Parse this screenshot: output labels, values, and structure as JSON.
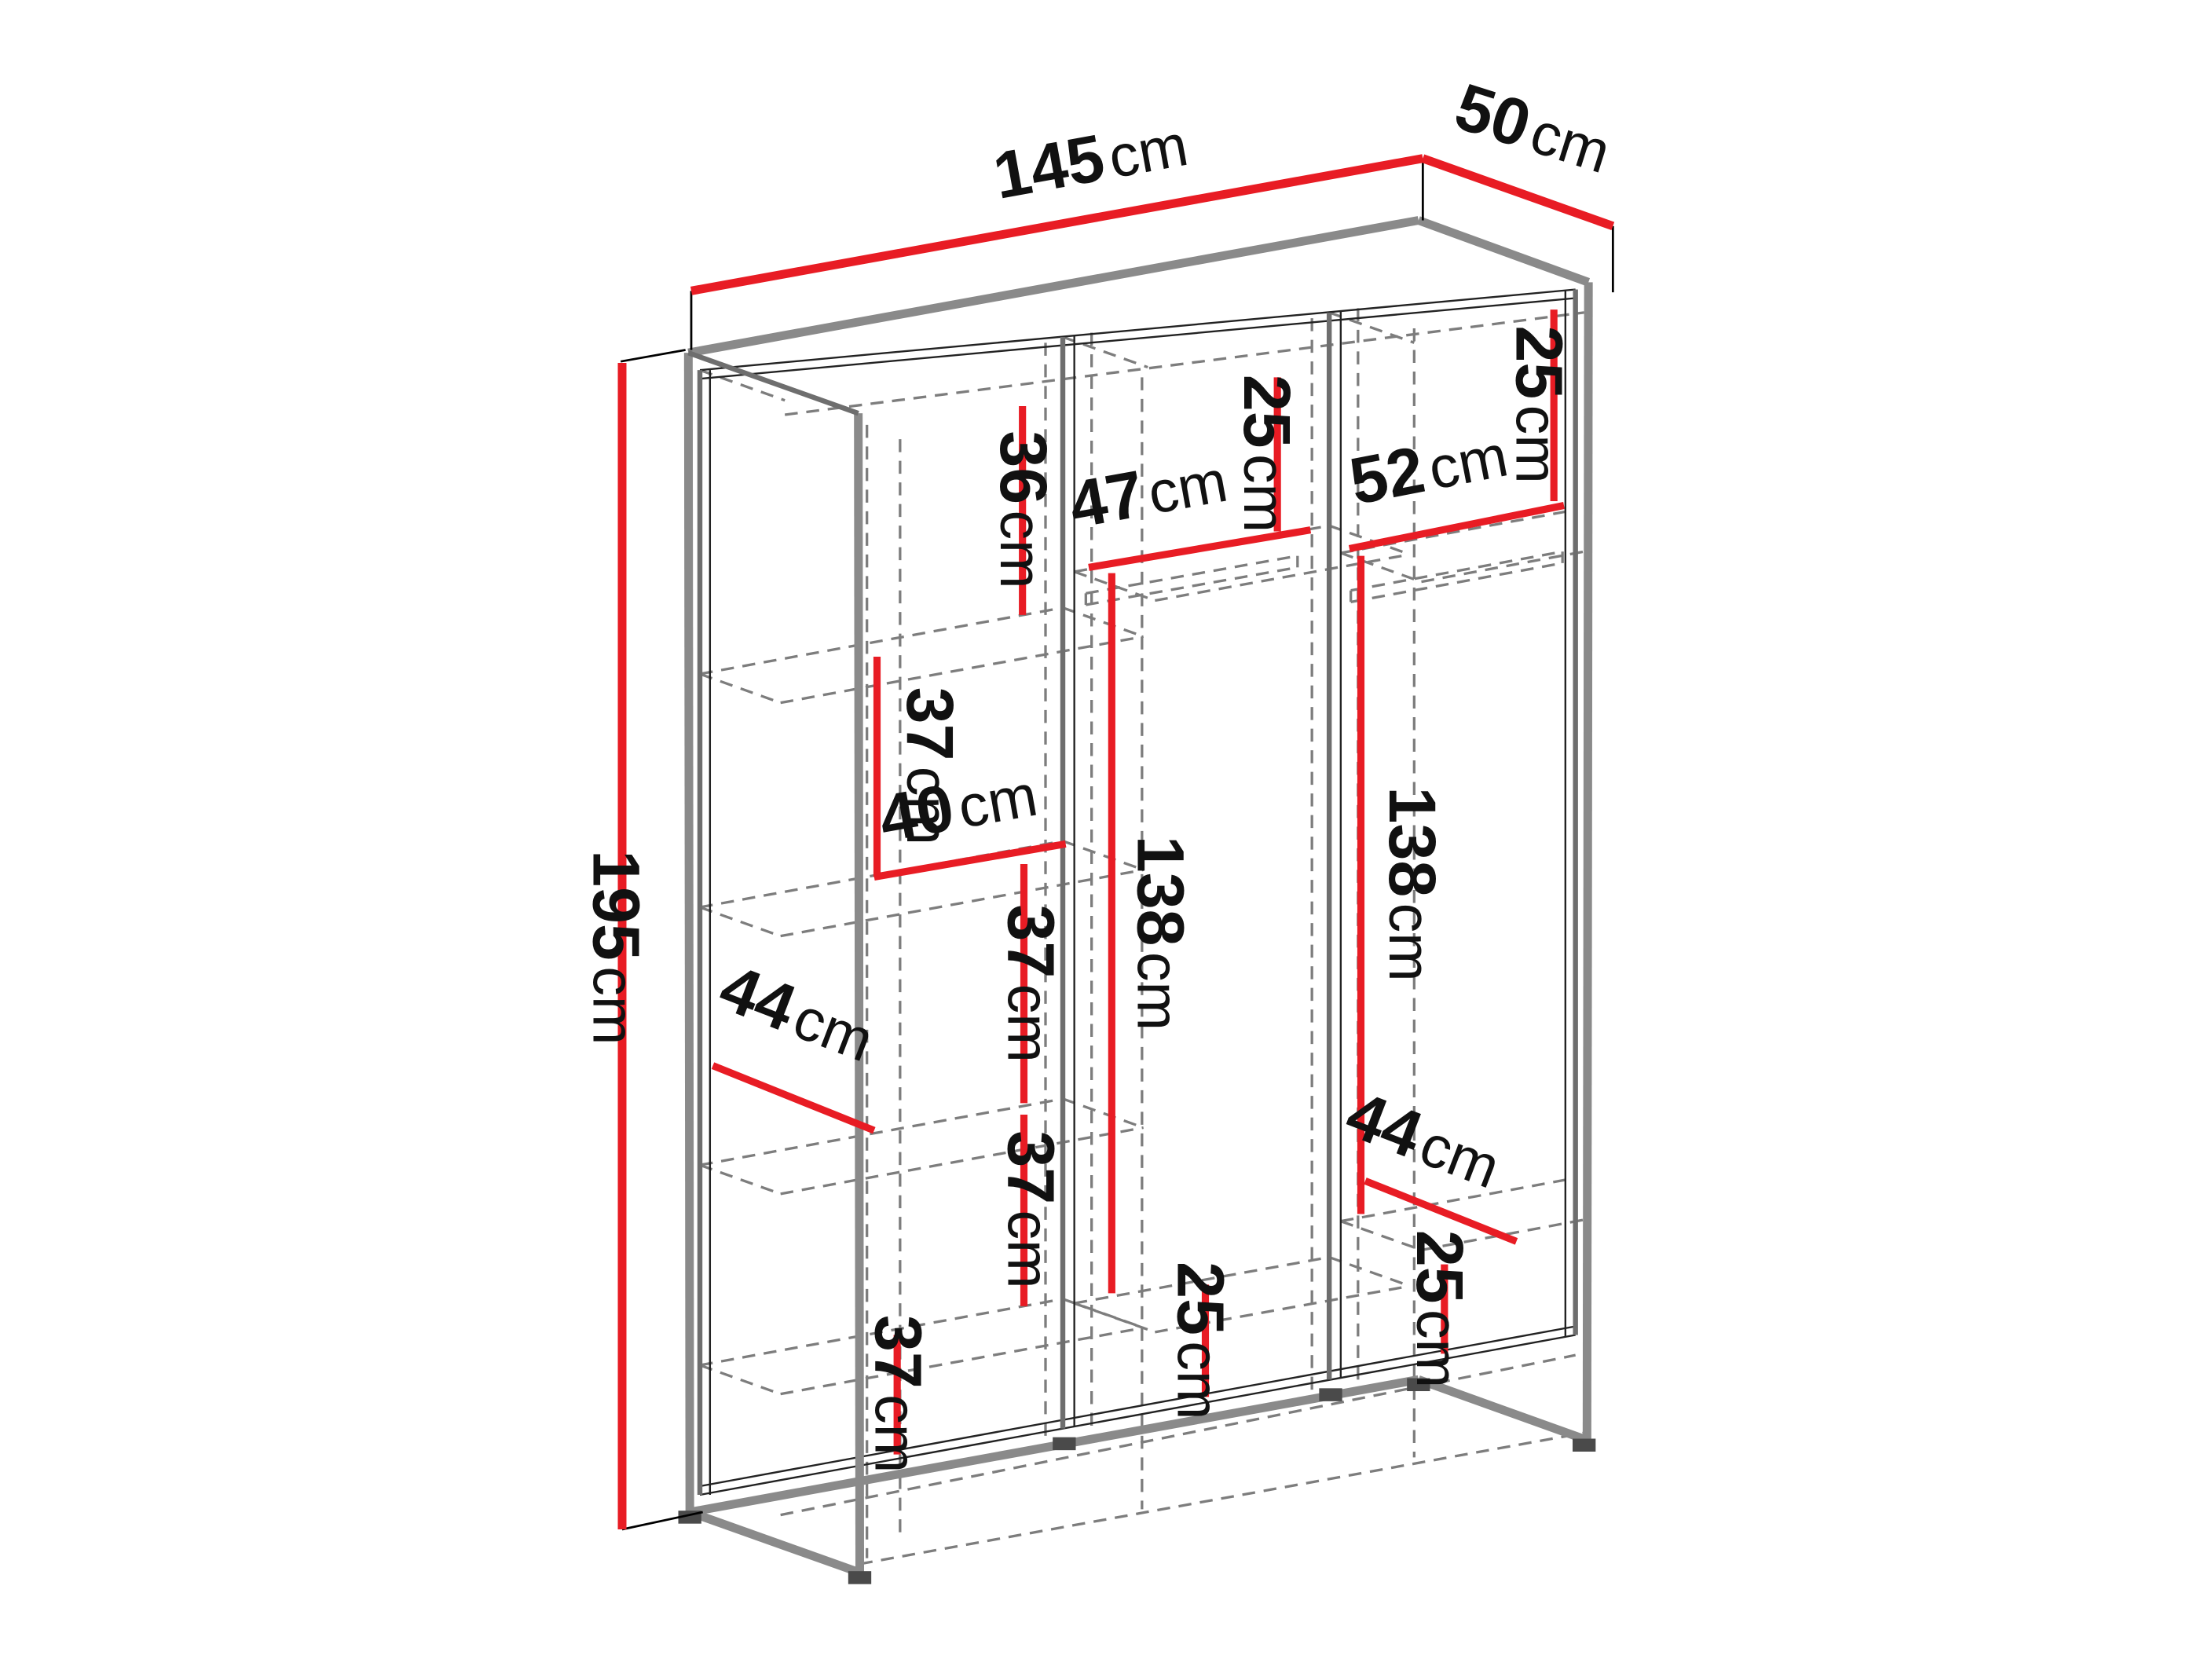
{
  "figure": {
    "type": "furniture-dimension-diagram",
    "subject": "three-section wardrobe line drawing in perspective",
    "background_color": "#ffffff",
    "accent_color": "#e81c24",
    "outline_color": "#8a8a8a",
    "hidden_line_color": "#7d7d7d",
    "text_color": "#111111"
  },
  "dimensions": {
    "width": {
      "value": "145",
      "unit": "cm"
    },
    "depth": {
      "value": "50",
      "unit": "cm"
    },
    "height": {
      "value": "195",
      "unit": "cm"
    },
    "col1_top_gap": {
      "value": "36",
      "unit": "cm"
    },
    "col1_gap2": {
      "value": "37",
      "unit": "cm"
    },
    "col1_shelf_width": {
      "value": "40",
      "unit": "cm"
    },
    "col1_gap3": {
      "value": "37",
      "unit": "cm"
    },
    "col1_shelf_depth": {
      "value": "44",
      "unit": "cm"
    },
    "col1_gap4": {
      "value": "37",
      "unit": "cm"
    },
    "col1_bottom_gap": {
      "value": "37",
      "unit": "cm"
    },
    "col2_top_gap": {
      "value": "25",
      "unit": "cm"
    },
    "col2_shelf_width": {
      "value": "47",
      "unit": "cm"
    },
    "col2_hanging": {
      "value": "138",
      "unit": "cm"
    },
    "col2_bottom_gap": {
      "value": "25",
      "unit": "cm"
    },
    "col3_top_gap": {
      "value": "25",
      "unit": "cm"
    },
    "col3_shelf_width": {
      "value": "52",
      "unit": "cm"
    },
    "col3_hanging": {
      "value": "138",
      "unit": "cm"
    },
    "col3_shelf_depth": {
      "value": "44",
      "unit": "cm"
    },
    "col3_bottom_gap": {
      "value": "25",
      "unit": "cm"
    }
  }
}
